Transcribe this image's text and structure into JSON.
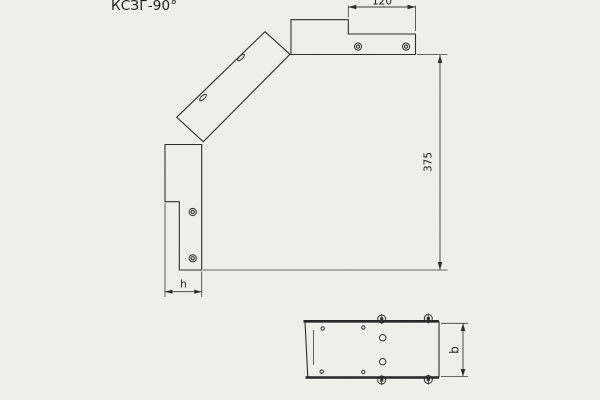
{
  "drawing": {
    "title": "КСЗГ-90°",
    "main_view": {
      "dim_width_top": "120",
      "dim_height": "375",
      "dim_flange": "h"
    },
    "bottom_view": {
      "dim_width": "b"
    },
    "colors": {
      "background": "#f1f1ee",
      "line": "#2d2d2d",
      "dim_line": "#3a3a3a",
      "text": "#1f1f1f"
    }
  }
}
